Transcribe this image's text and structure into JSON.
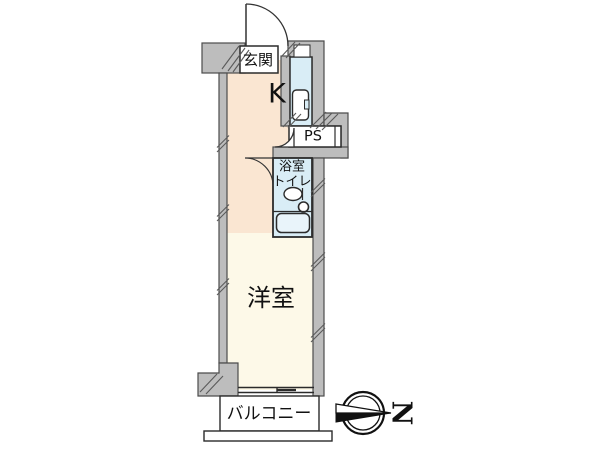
{
  "plan": {
    "entrance_label": "玄関",
    "kitchen_label": "K",
    "pipe_space_label": "PS",
    "bathroom_label_line1": "浴室",
    "bathroom_label_line2": "トイレ",
    "western_room_label": "洋室",
    "balcony_label": "バルコニー"
  },
  "compass": {
    "north_label": "N"
  },
  "colors": {
    "wall": "#bdbdbd",
    "floor-kitchen": "#fae6d2",
    "floor-room": "#fdf9e8",
    "wet-area": "#d9edf6",
    "bathtub": "#e9f4fa",
    "line": "#2b2b2b",
    "hatch": "#5a5a5a"
  }
}
